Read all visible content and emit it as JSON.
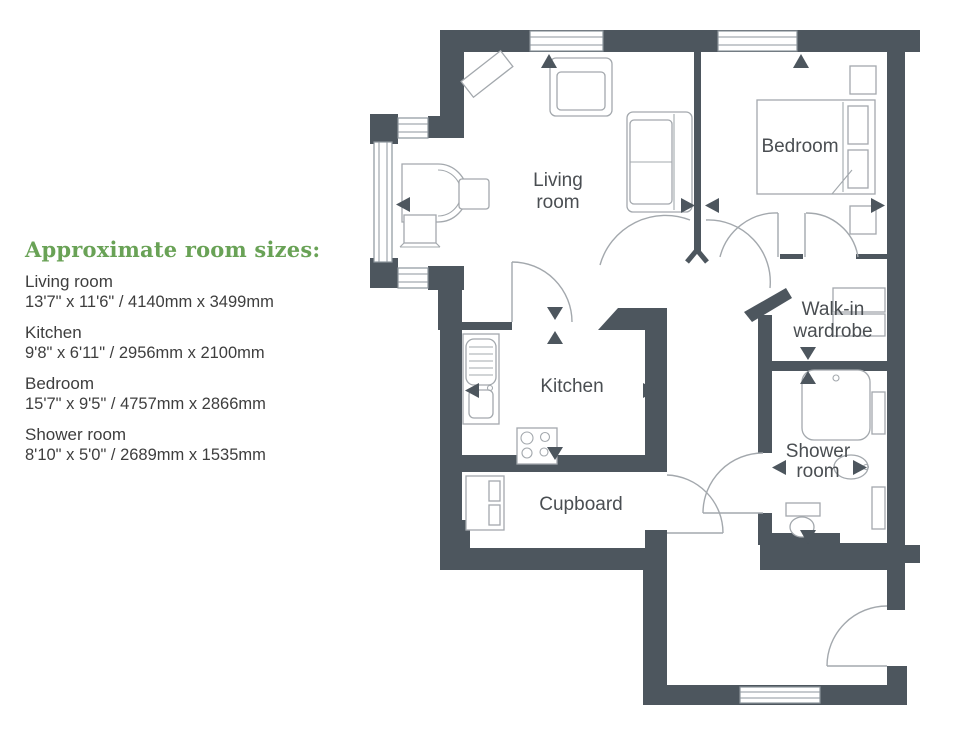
{
  "legend": {
    "title": "Approximate room sizes:",
    "title_color": "#69a256",
    "entries": [
      {
        "name": "Living room",
        "size": "13'7\" x 11'6\" / 4140mm x 3499mm"
      },
      {
        "name": "Kitchen",
        "size": "9'8\" x 6'11\" / 2956mm x 2100mm"
      },
      {
        "name": "Bedroom",
        "size": "15'7\" x 9'5\" / 4757mm x 2866mm"
      },
      {
        "name": "Shower room",
        "size": "8'10\" x 5'0\" / 2689mm x 1535mm"
      }
    ]
  },
  "floorplan": {
    "wall_color": "#4d565e",
    "labels": {
      "living": [
        "Living",
        "room"
      ],
      "bedroom": "Bedroom",
      "kitchen": "Kitchen",
      "cupboard": "Cupboard",
      "walkin": [
        "Walk-in",
        "wardrobe"
      ],
      "shower": [
        "Shower",
        "room"
      ]
    }
  }
}
